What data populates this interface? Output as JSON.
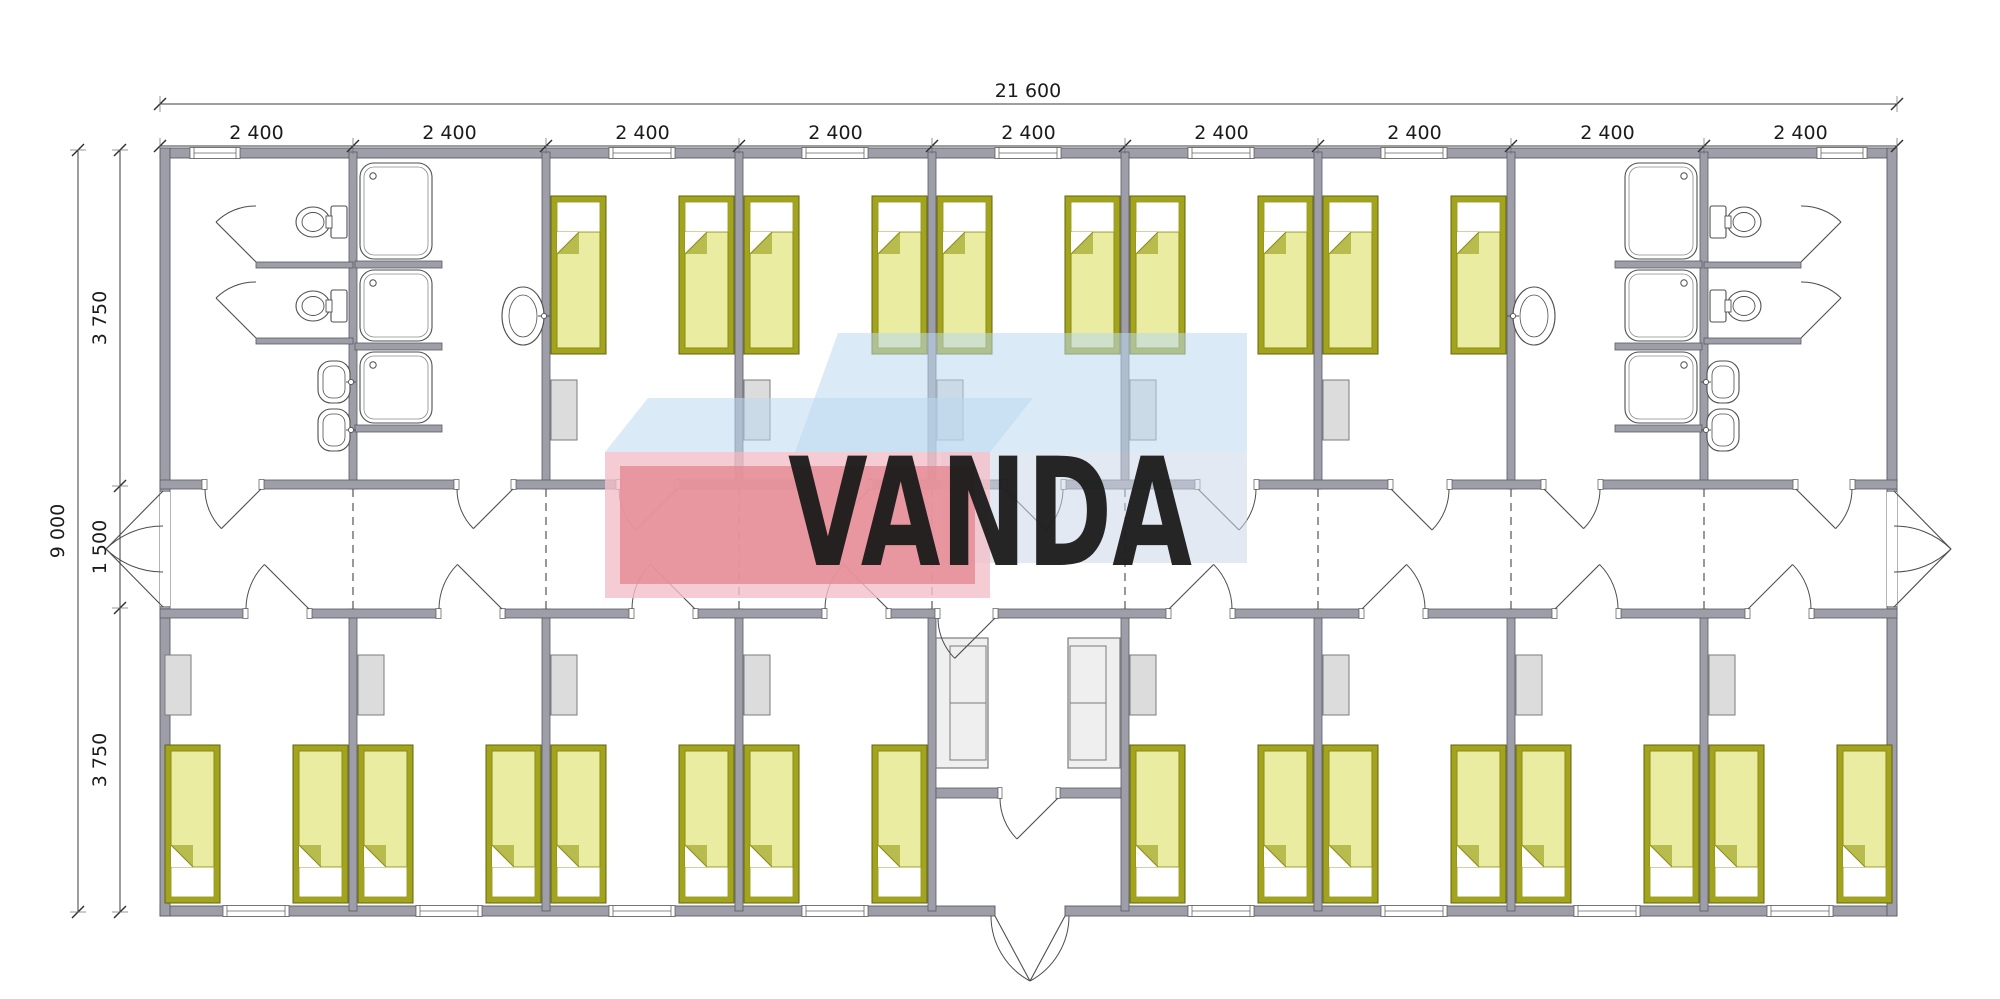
{
  "watermark": {
    "text": "VANDA"
  },
  "dimensions": {
    "overall_width": "21 600",
    "module_width": "2 400",
    "module_count": 9,
    "overall_height": "9 000",
    "top_row_depth": "3 750",
    "corridor_width": "1 500",
    "bottom_row_depth": "3 750"
  },
  "colors": {
    "wall": "#9e9ea8",
    "wall_stroke": "#5a5a64",
    "line": "#4d4d4d",
    "bed_frame": "#a3a41e",
    "bed_frame_stroke": "#63640a",
    "bed_blanket": "#e9eca1",
    "bed_blanket_stroke": "#8b8c15",
    "bed_fold": "#b8bb4e",
    "pillow": "#ffffff",
    "furniture": "#dcdcdc",
    "furniture_stroke": "#7b7b7b",
    "sofa": "#efefef",
    "fixture_fill": "#ffffff",
    "fixture_stroke": "#4f4f4f",
    "watermark_pink": "#f2bfc8",
    "watermark_pink_inner": "#e58994",
    "watermark_blue": "#bcd9ee",
    "watermark_blue_front": "#ccd7e8",
    "watermark_text": "#ffffff"
  },
  "inventory": {
    "modules": 9,
    "top_row_bedrooms": 5,
    "bottom_row_bedrooms": 8,
    "beds_total": 26,
    "bathrooms": 2,
    "toilets": 4,
    "showers": 6,
    "hand_basins": 6,
    "entrance_sofas": 2,
    "wardrobes": 13
  }
}
